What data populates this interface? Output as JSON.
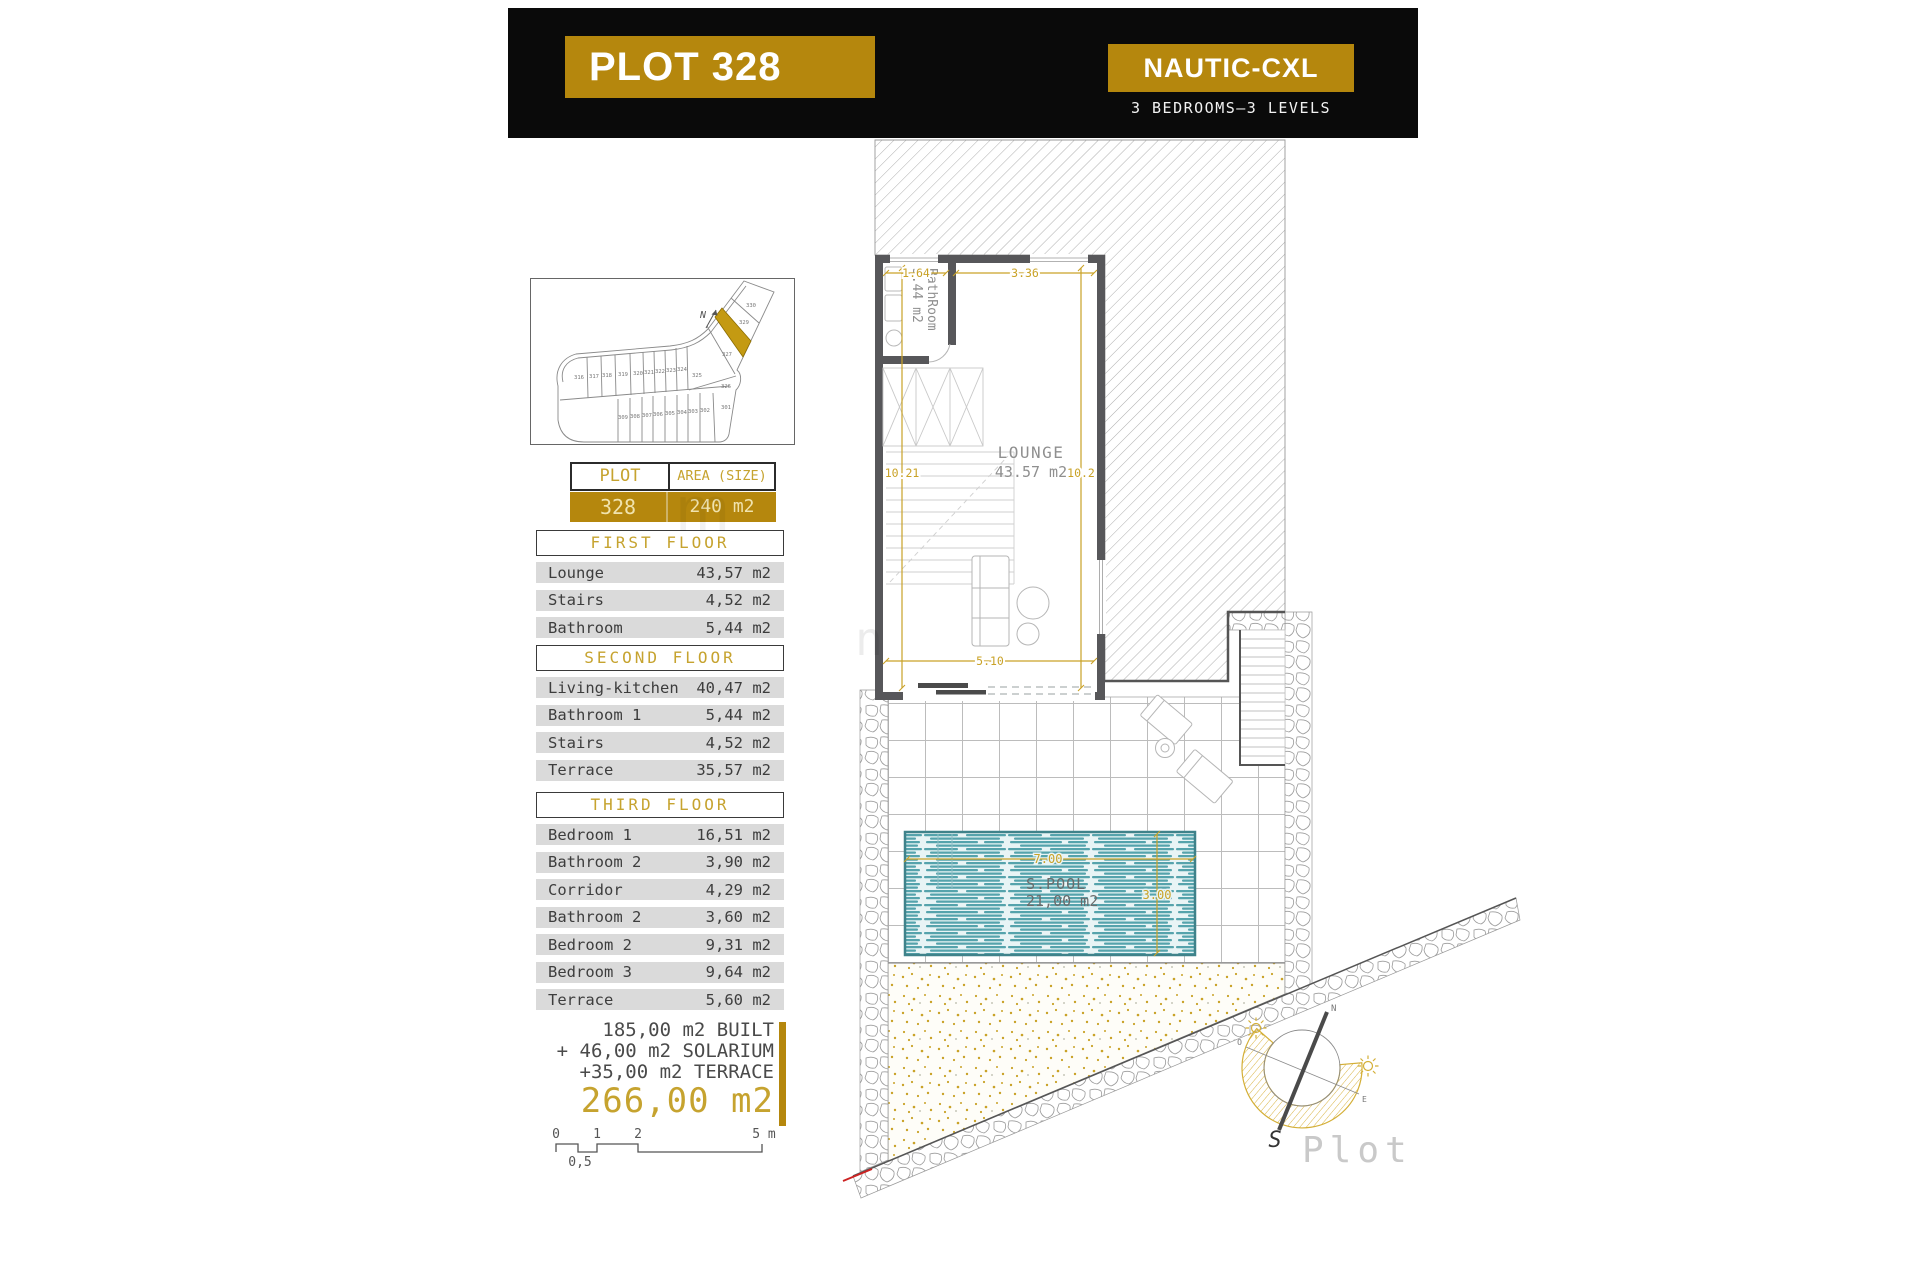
{
  "header": {
    "plot_title": "PLOT 328",
    "model_name": "NAUTIC-CXL",
    "subtitle": "3 BEDROOMS—3 LEVELS"
  },
  "site_map": {
    "north": "N",
    "highlighted_plot": "328",
    "plots": [
      "330",
      "329",
      "327",
      "325",
      "326",
      "316",
      "317",
      "318",
      "319",
      "320",
      "321",
      "322",
      "323",
      "324",
      "309",
      "308",
      "307",
      "306",
      "305",
      "304",
      "303",
      "302",
      "301"
    ]
  },
  "plot_table": {
    "col1_header": "PLOT",
    "col2_header": "AREA (SIZE)",
    "plot_number": "328",
    "area": "240 m2"
  },
  "floors": [
    {
      "title": "FIRST FLOOR",
      "rows": [
        {
          "label": "Lounge",
          "value": "43,57 m2"
        },
        {
          "label": "Stairs",
          "value": "4,52 m2"
        },
        {
          "label": "Bathroom",
          "value": "5,44 m2"
        }
      ]
    },
    {
      "title": "SECOND FLOOR",
      "rows": [
        {
          "label": "Living-kitchen",
          "value": "40,47 m2"
        },
        {
          "label": "Bathroom 1",
          "value": "5,44 m2"
        },
        {
          "label": "Stairs",
          "value": "4,52 m2"
        },
        {
          "label": "Terrace",
          "value": "35,57 m2"
        }
      ]
    },
    {
      "title": "THIRD FLOOR",
      "rows": [
        {
          "label": "Bedroom 1",
          "value": "16,51 m2"
        },
        {
          "label": "Bathroom 2",
          "value": "3,90 m2"
        },
        {
          "label": "Corridor",
          "value": "4,29 m2"
        },
        {
          "label": "Bathroom 2",
          "value": "3,60 m2"
        },
        {
          "label": "Bedroom 2",
          "value": "9,31 m2"
        },
        {
          "label": "Bedroom 3",
          "value": "9,64 m2"
        },
        {
          "label": "Terrace",
          "value": "5,60 m2"
        }
      ]
    }
  ],
  "totals": {
    "line1": "185,00 m2 BUILT",
    "line2": "+ 46,00 m2 SOLARIUM",
    "line3": "+35,00 m2 TERRACE",
    "total": "266,00 m2"
  },
  "scale_bar": {
    "t0": "0",
    "t1": "1",
    "t2": "2",
    "t5": "5 m",
    "half": "0,5"
  },
  "plan": {
    "bathroom_line1": "BathRoom",
    "bathroom_line2": "5.44 m2",
    "lounge_line1": "LOUNGE",
    "lounge_line2": "43.57 m2",
    "dim_bath_width": "1.64",
    "dim_lounge_width": "3.36",
    "dim_left_height": "10.21",
    "dim_right_height": "10.2",
    "dim_bottom_width": "5.10",
    "pool_name": "S.POOL",
    "pool_area": "21,00 m2",
    "pool_width": "7.00",
    "pool_depth": "3.00",
    "compass": {
      "n": "N",
      "s": "S",
      "o": "O",
      "e": "E",
      "brand": "Plot"
    }
  },
  "watermark": {
    "letter1": "m",
    "letter2": "n"
  },
  "colors": {
    "brand_gold": "#b5870d",
    "accent_gold": "#c9a227",
    "header_black": "#0a0a0a",
    "row_gray": "#dadada",
    "pool_teal": "#55a3ac",
    "wall_gray": "#57575a"
  }
}
